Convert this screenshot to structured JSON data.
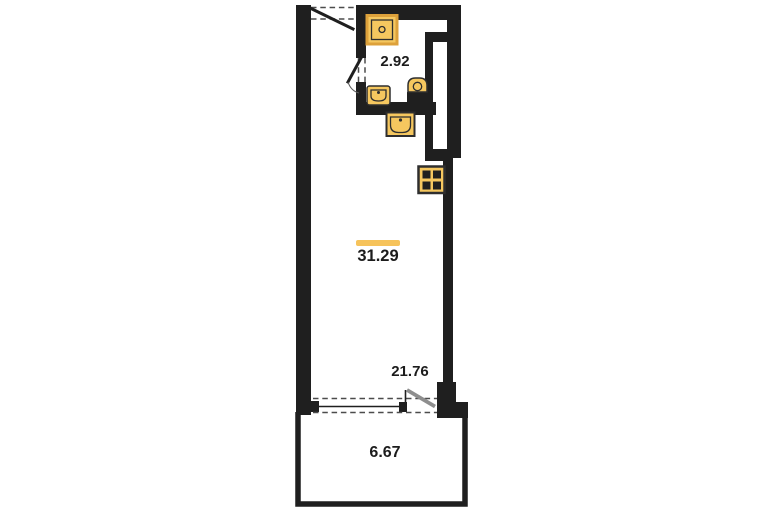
{
  "plan": {
    "type": "apartment-floor-plan",
    "area_labels": [
      {
        "id": "bathroom",
        "value": "2.92"
      },
      {
        "id": "total",
        "value": "31.29",
        "highlighted": true
      },
      {
        "id": "living-room",
        "value": "21.76"
      },
      {
        "id": "balcony",
        "value": "6.67"
      }
    ],
    "fixtures": [
      "shower",
      "washbasin",
      "toilet",
      "kitchen-sink",
      "stove"
    ],
    "doors": [
      "entrance-door",
      "bathroom-door",
      "balcony-door"
    ],
    "windows": [
      "balcony-window"
    ]
  },
  "colors": {
    "background": "#ffffff",
    "wall": "#1f1f1f",
    "fixture_fill": "#F5C75F",
    "fixture_border": "#DDA13B",
    "fixture_line": "#2e2e2e",
    "highlight": "#F6C35B",
    "door_leaf_gray": "#8e8e8e",
    "dash": "#4c4c4c",
    "text": "#1c1c1c"
  }
}
